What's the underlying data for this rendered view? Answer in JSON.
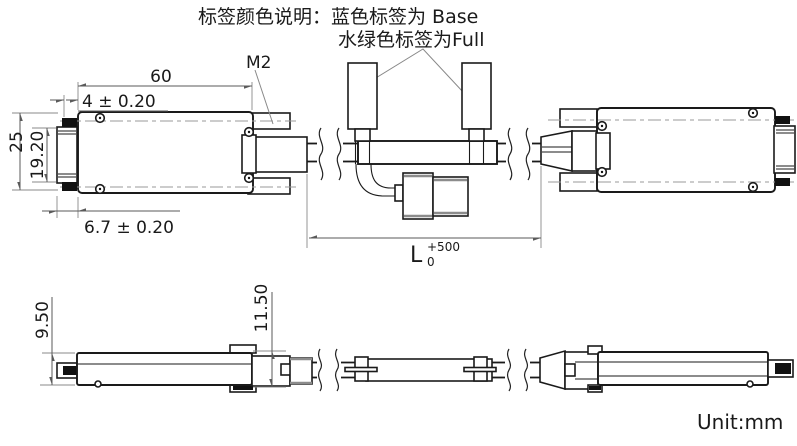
{
  "annotation": {
    "line1": "标签颜色说明：蓝色标签为 Base",
    "line2": "水绿色标签为Full"
  },
  "dims": {
    "length60": "60",
    "offset4": "4 ± 0.20",
    "offset67": "6.7 ± 0.20",
    "h25": "25",
    "h1920": "19.20",
    "thread": "M2",
    "L": {
      "base": "L",
      "upper": "+500",
      "lower": "0"
    },
    "h950": "9.50",
    "h1150": "11.50"
  },
  "footer": {
    "unit": "Unit:mm"
  },
  "colors": {
    "line": "#1a1a1a",
    "dimension": "#5a5a5a",
    "centerline": "#9a9a9a",
    "accent_gray": "#8c8c8c",
    "background": "#ffffff"
  }
}
